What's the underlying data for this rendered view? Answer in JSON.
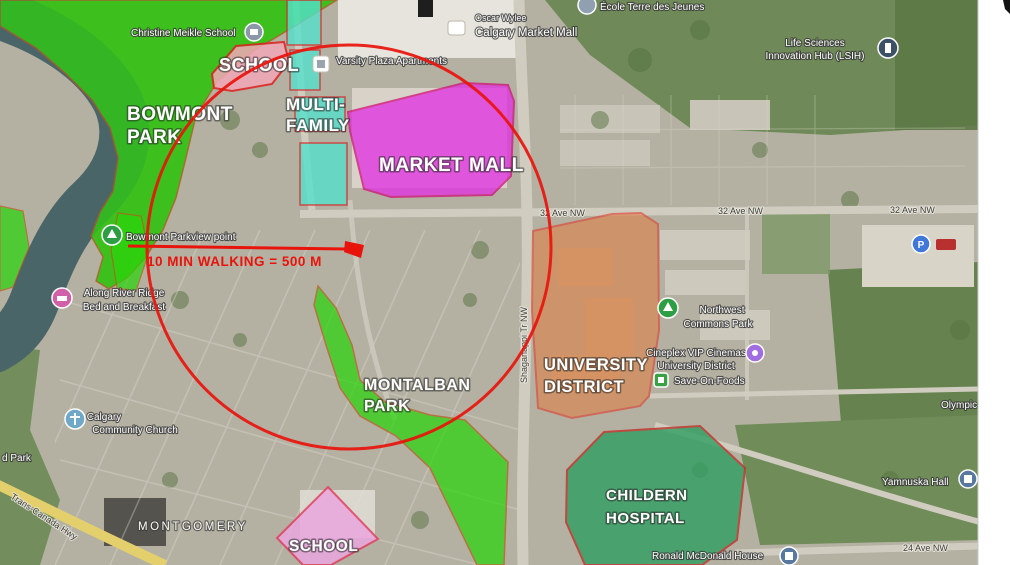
{
  "zones": {
    "bowmont_park": {
      "lines": [
        "BOWMONT",
        "PARK"
      ],
      "fill": "#2bd40a"
    },
    "school_north": {
      "lines": [
        "SCHOOL"
      ],
      "fill": "#f2a8b8"
    },
    "multi_family": {
      "lines": [
        "MULTI-",
        "FAMILY"
      ],
      "fill": "#55e0cb"
    },
    "market_mall": {
      "lines": [
        "MARKET MALL"
      ],
      "fill": "#e233e2"
    },
    "university_district": {
      "lines": [
        "UNIVERSITY",
        "DISTRICT"
      ],
      "fill": "#df8146"
    },
    "montalban_park": {
      "lines": [
        "MONTALBAN",
        "PARK"
      ],
      "fill": "#2bd40a"
    },
    "school_south": {
      "lines": [
        "SCHOOL"
      ],
      "fill": "#eaa6de"
    },
    "childern_hospital": {
      "lines": [
        "CHILDERN",
        "HOSPITAL"
      ],
      "fill": "#2f9e62"
    }
  },
  "annotation": {
    "walking_label": "10 MIN WALKING = 500 M",
    "accent_color": "#e8140c"
  },
  "roads": {
    "ave32": "32 Ave NW",
    "ave24": "24 Ave NW",
    "shaganappi": "Shaganappi Tr NW",
    "trans_canada": "Trans-Canada Hwy"
  },
  "districts": {
    "montgomery": "MONTGOMERY"
  },
  "pois": {
    "christine_meikle": "Christine Meikle School",
    "ecole_terre": "École Terre des Jeunes",
    "life_sciences": [
      "Life Sciences",
      "Innovation Hub (LSIH)"
    ],
    "oscar_wylee": "Oscar Wylee",
    "calgary_market_mall": "Calgary Market Mall",
    "varsity_plaza": "Varsity Plaza Apartments",
    "bowmont_viewpoint": "Bowmont Parkview point",
    "along_river_bb": [
      "Along River Ridge",
      "Bed and Breakfast"
    ],
    "community_church": [
      "Calgary",
      "Community Church"
    ],
    "northwest_commons": [
      "Northwest",
      "Commons Park"
    ],
    "cineplex": [
      "Cineplex VIP Cinemas",
      "University District"
    ],
    "save_on_foods": "Save-On-Foods",
    "yamnuska_hall": "Yamnuska Hall",
    "ronald_mcdonald": "Ronald McDonald House",
    "olympic": "Olympic",
    "park_fragment": "d Park",
    "parking_letter": "P"
  }
}
